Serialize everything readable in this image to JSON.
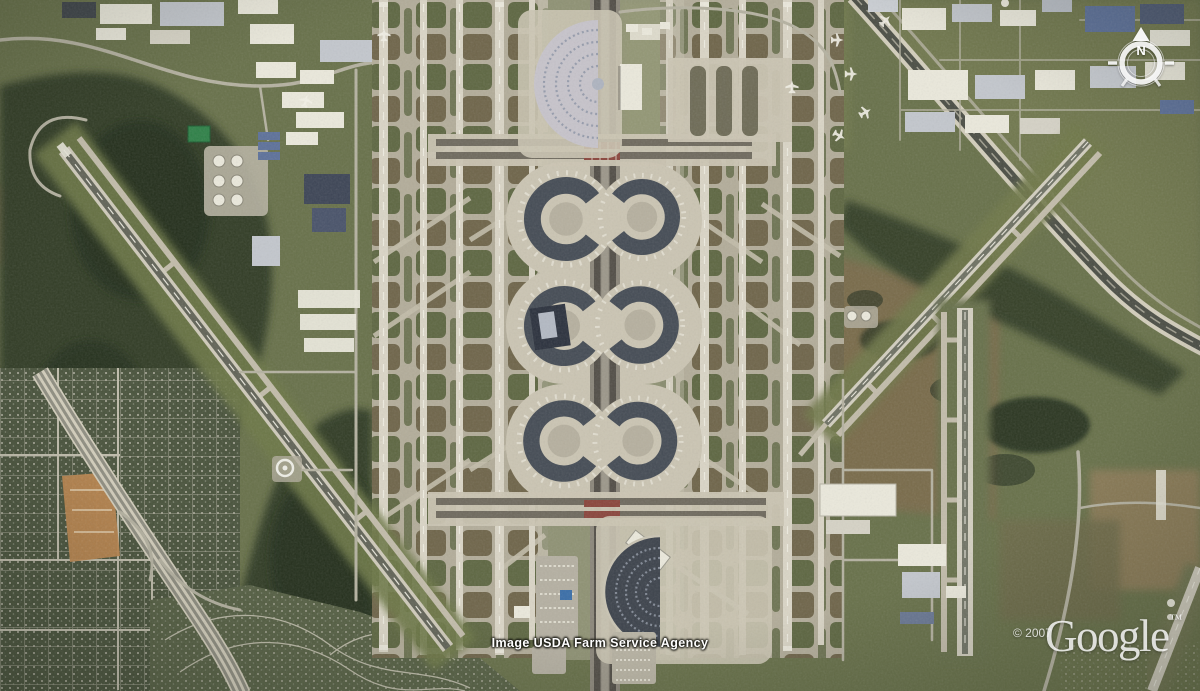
{
  "palette": {
    "base_olive": "#68714a",
    "forest_dark": "#303c27",
    "forest_deep": "#242f1f",
    "field_brown": "#7b6a4b",
    "field_tan": "#8d7c59",
    "field_green": "#747d4e",
    "pavement": "#b3ad9a",
    "pavement_light": "#cbc5b3",
    "runway": "#dad5c6",
    "taxiway": "#c2bcaa",
    "infield_olive": "#5a633d",
    "infield_brown": "#6b6146",
    "terminal_dark": "#454c55",
    "terminal_deep": "#2c323e",
    "spine": "#8b867a",
    "lane_dark": "#524e47",
    "toll_red": "#8a453c",
    "residential": "#49533c",
    "residential_light": "#566044",
    "street": "#b5b2a1",
    "building_white": "#ebe9dc",
    "building_blue": "#5d719a",
    "roof_gray": "#c3c7cd",
    "highway_dark": "#4b4e45",
    "highway_pale": "#d3cebc",
    "water_green": "#2f8148",
    "construction": "#b9854e"
  },
  "overlays": {
    "attribution_text": "Image USDA Farm Service Agency",
    "copyright_text": "© 2007",
    "logo_text": "Google",
    "trademark_text": "™",
    "compass_north_label": "N",
    "compass_icon": "compass-rose"
  }
}
